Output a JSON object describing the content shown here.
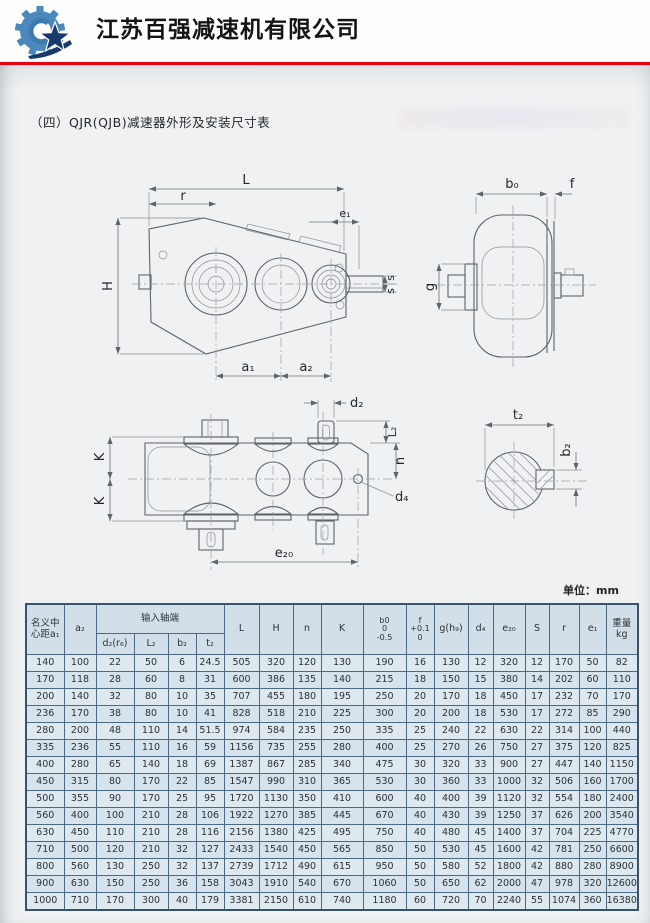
{
  "header": {
    "company_name": "江苏百强减速机有限公司",
    "logo": "gear-star-logo"
  },
  "page": {
    "title": "（四）QJR(QJB)减速器外形及安装尺寸表",
    "unit_label": "单位：mm"
  },
  "drawings": {
    "front_view": {
      "labels": {
        "L": "L",
        "r": "r",
        "e1": "e₁",
        "H": "H",
        "s_top": "s",
        "s_bottom": "s",
        "a1": "a₁",
        "a2": "a₂"
      }
    },
    "side_view": {
      "labels": {
        "b0": "b₀",
        "f": "f",
        "g": "g"
      }
    },
    "top_view": {
      "labels": {
        "d2": "d₂",
        "L2": "L₂",
        "n": "n",
        "d4": "d₄",
        "K_top": "K",
        "K_bottom": "K",
        "e20": "e₂₀"
      }
    },
    "shaft_section": {
      "labels": {
        "t2": "t₂",
        "b2": "b₂"
      }
    }
  },
  "table": {
    "header": {
      "col_a1": "名义中\n心距a₁",
      "col_a2": "a₂",
      "group_input": "输入轴端",
      "sub": [
        "d₂(r₆)",
        "L₂",
        "b₂",
        "t₂"
      ],
      "cols": [
        "L",
        "H",
        "n",
        "K",
        "b0\n0\n-0.5",
        "f\n+0.1\n0",
        "g(h₉)",
        "d₄",
        "e₂₀",
        "S",
        "r",
        "e₁",
        "重量kg"
      ]
    },
    "rows": [
      [
        140,
        100,
        22,
        50,
        6,
        24.5,
        505,
        320,
        120,
        130,
        190,
        16,
        130,
        12,
        320,
        12,
        170,
        50,
        82
      ],
      [
        170,
        118,
        28,
        60,
        8,
        31,
        600,
        386,
        135,
        140,
        215,
        18,
        150,
        15,
        380,
        14,
        202,
        60,
        110
      ],
      [
        200,
        140,
        32,
        80,
        10,
        35,
        707,
        455,
        180,
        195,
        250,
        20,
        170,
        18,
        450,
        17,
        232,
        70,
        170
      ],
      [
        236,
        170,
        38,
        80,
        10,
        41,
        828,
        518,
        210,
        225,
        300,
        20,
        200,
        18,
        530,
        17,
        272,
        85,
        290
      ],
      [
        280,
        200,
        48,
        110,
        14,
        51.5,
        974,
        584,
        235,
        250,
        335,
        25,
        240,
        22,
        630,
        22,
        314,
        100,
        440
      ],
      [
        335,
        236,
        55,
        110,
        16,
        59,
        1156,
        735,
        255,
        280,
        400,
        25,
        270,
        26,
        750,
        27,
        375,
        120,
        825
      ],
      [
        400,
        280,
        65,
        140,
        18,
        69,
        1387,
        867,
        285,
        340,
        475,
        30,
        320,
        33,
        900,
        27,
        447,
        140,
        1150
      ],
      [
        450,
        315,
        80,
        170,
        22,
        85,
        1547,
        990,
        310,
        365,
        530,
        30,
        360,
        33,
        1000,
        32,
        506,
        160,
        1700
      ],
      [
        500,
        355,
        90,
        170,
        25,
        95,
        1720,
        1130,
        350,
        410,
        600,
        40,
        400,
        39,
        1120,
        32,
        554,
        180,
        2400
      ],
      [
        560,
        400,
        100,
        210,
        28,
        106,
        1922,
        1270,
        385,
        445,
        670,
        40,
        430,
        39,
        1250,
        37,
        626,
        200,
        3540
      ],
      [
        630,
        450,
        110,
        210,
        28,
        116,
        2156,
        1380,
        425,
        495,
        750,
        40,
        480,
        45,
        1400,
        37,
        704,
        225,
        4770
      ],
      [
        710,
        500,
        120,
        210,
        32,
        127,
        2433,
        1540,
        450,
        565,
        850,
        50,
        530,
        45,
        1600,
        42,
        781,
        250,
        6600
      ],
      [
        800,
        560,
        130,
        250,
        32,
        137,
        2739,
        1712,
        490,
        615,
        950,
        50,
        580,
        52,
        1800,
        42,
        880,
        280,
        8900
      ],
      [
        900,
        630,
        150,
        250,
        36,
        158,
        3043,
        1910,
        540,
        670,
        1060,
        50,
        650,
        62,
        2000,
        47,
        978,
        320,
        12600
      ],
      [
        1000,
        710,
        170,
        300,
        40,
        179,
        3381,
        2150,
        610,
        740,
        1180,
        60,
        720,
        70,
        2240,
        55,
        1074,
        360,
        16380
      ]
    ]
  }
}
